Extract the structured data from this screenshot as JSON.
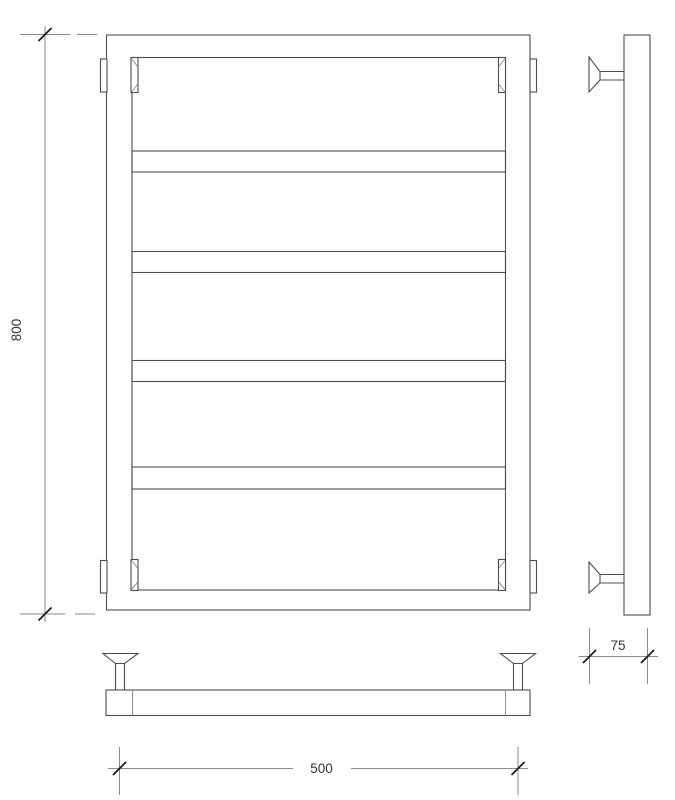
{
  "drawing": {
    "type": "technical-drawing-towel-rail",
    "background": "#ffffff",
    "colors": {
      "object_line": "#4d4d4d",
      "detail_line": "#8f8f8f",
      "dimension_line": "#8a8a8a",
      "tick": "#1c1c1c",
      "text": "#333333"
    },
    "dimensions": {
      "height": "800",
      "width": "500",
      "depth": "75"
    }
  }
}
